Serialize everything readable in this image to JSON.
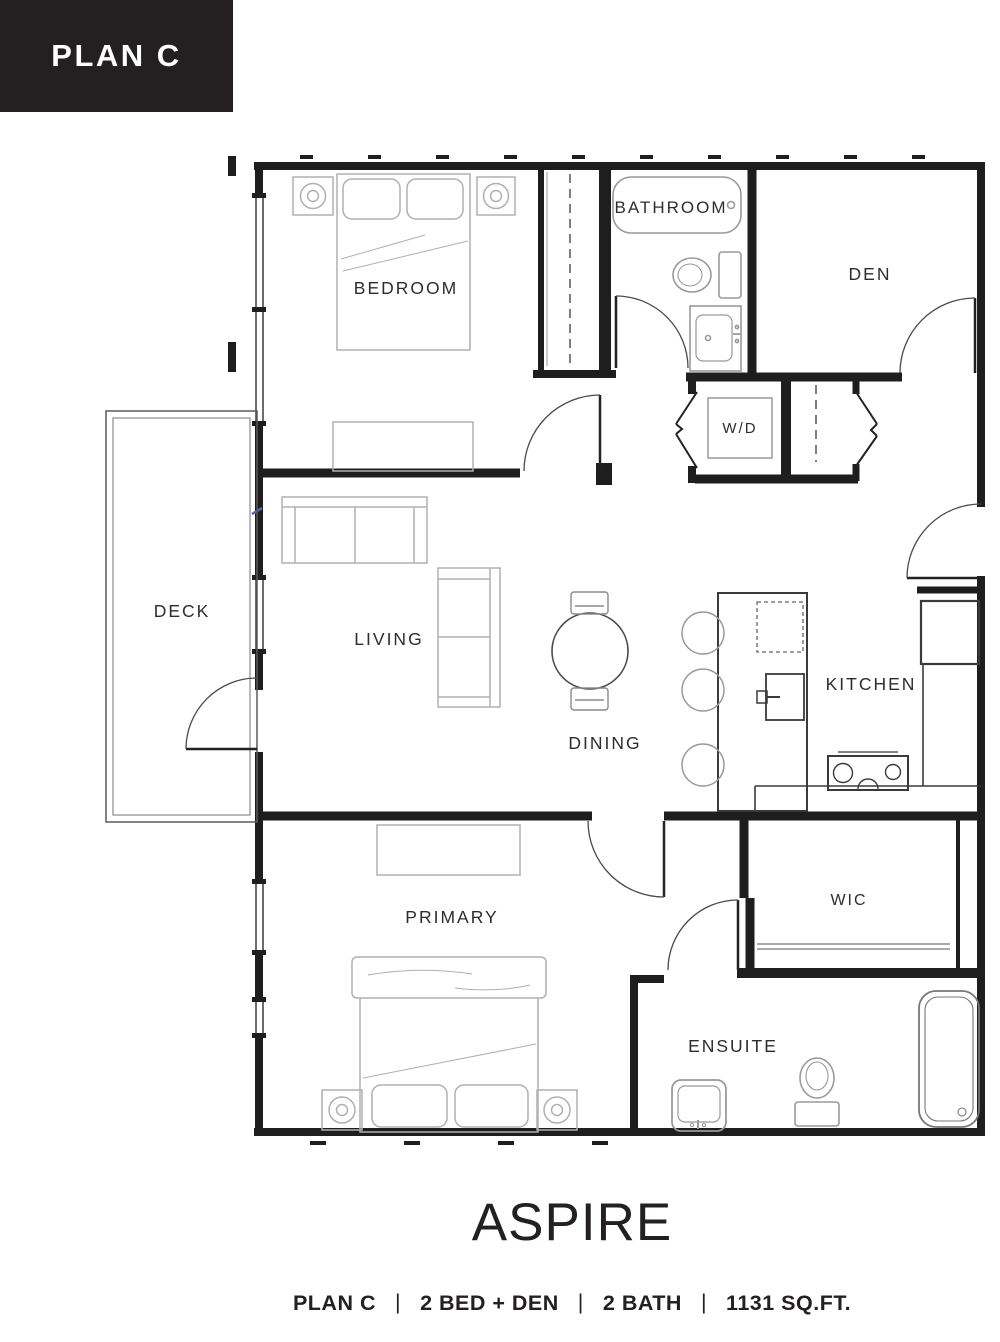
{
  "header": {
    "plan_label": "PLAN C"
  },
  "floorplan": {
    "rooms": {
      "bedroom": "BEDROOM",
      "bathroom": "BATHROOM",
      "den": "DEN",
      "laundry": "W/D",
      "deck": "DECK",
      "living": "LIVING",
      "dining": "DINING",
      "kitchen": "KITCHEN",
      "primary": "PRIMARY",
      "wic": "WIC",
      "ensuite": "ENSUITE"
    }
  },
  "footer": {
    "building_name": "ASPIRE",
    "specs": [
      "PLAN C",
      "2 BED + DEN",
      "2 BATH",
      "1131 SQ.FT."
    ],
    "separator": "|"
  },
  "colors": {
    "wall": "#1e1e1e",
    "furniture": "#b0b0b0",
    "fixture": "#9a9a9a",
    "kitchen_line": "#3a3a3a",
    "label": "#2f2c2d",
    "header_bg": "#242021",
    "header_text": "#ffffff",
    "accent_mark": "#4a6fbd"
  }
}
